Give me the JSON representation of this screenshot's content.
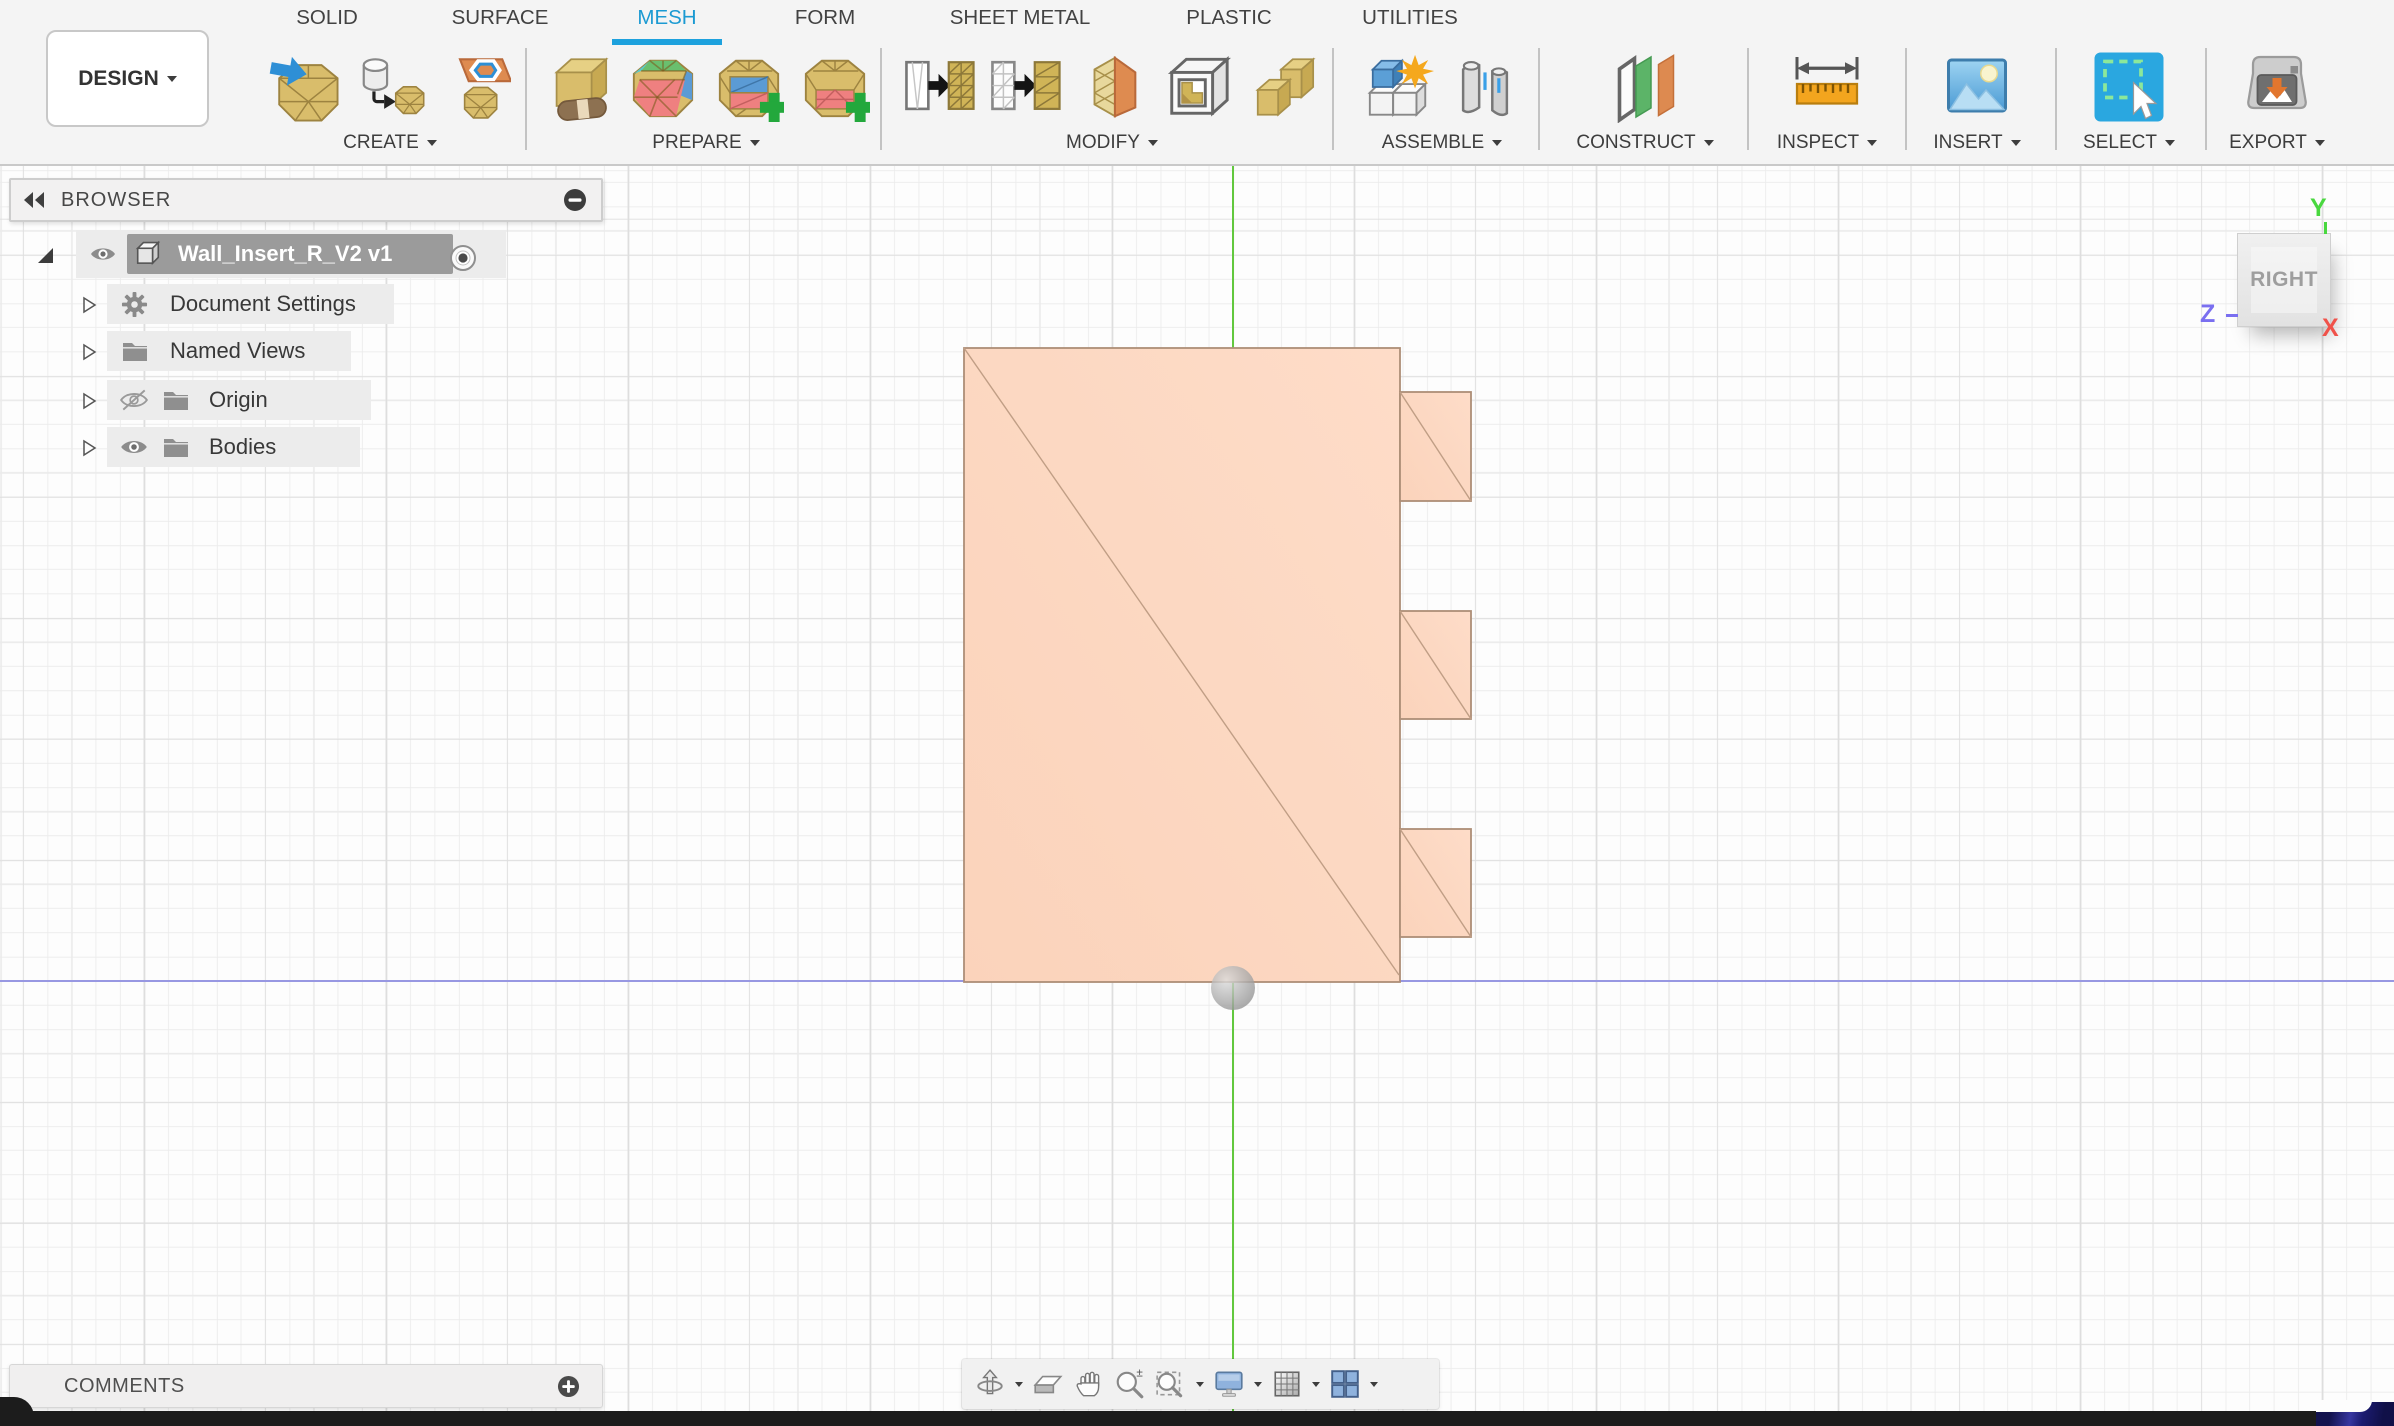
{
  "toolbar": {
    "document_menu_label": "DESIGN",
    "tabs": [
      {
        "label": "SOLID",
        "active": false
      },
      {
        "label": "SURFACE",
        "active": false
      },
      {
        "label": "MESH",
        "active": true
      },
      {
        "label": "FORM",
        "active": false
      },
      {
        "label": "SHEET METAL",
        "active": false
      },
      {
        "label": "PLASTIC",
        "active": false
      },
      {
        "label": "UTILITIES",
        "active": false
      }
    ],
    "groups": [
      {
        "label": "CREATE",
        "icons": [
          "insert-mesh",
          "create-mesh",
          "tessellate"
        ]
      },
      {
        "label": "PREPARE",
        "icons": [
          "repair",
          "generate-face-groups",
          "remesh",
          "reduce"
        ]
      },
      {
        "label": "MODIFY",
        "icons": [
          "plane-cut",
          "plane-cut-fill",
          "erase-and-fill",
          "shell",
          "merge-bodies"
        ]
      },
      {
        "label": "ASSEMBLE",
        "icons": [
          "new-component",
          "joint"
        ]
      },
      {
        "label": "CONSTRUCT",
        "icons": [
          "construct-plane"
        ]
      },
      {
        "label": "INSPECT",
        "icons": [
          "measure"
        ]
      },
      {
        "label": "INSERT",
        "icons": [
          "insert-image"
        ]
      },
      {
        "label": "SELECT",
        "icons": [
          "select-cursor"
        ]
      },
      {
        "label": "EXPORT",
        "icons": [
          "export-3d-print"
        ]
      }
    ],
    "accent_color": "#1da1dd"
  },
  "browser": {
    "title": "BROWSER",
    "root_item": {
      "label": "Wall_Insert_R_V2 v1",
      "visible": true,
      "selected": true
    },
    "items": [
      {
        "label": "Document Settings",
        "icon": "gear"
      },
      {
        "label": "Named Views",
        "icon": "folder"
      },
      {
        "label": "Origin",
        "icon": "folder",
        "visibility": "hidden"
      },
      {
        "label": "Bodies",
        "icon": "folder",
        "visibility": "visible"
      }
    ]
  },
  "viewcube": {
    "face_label": "RIGHT",
    "axis_x_label": "X",
    "axis_y_label": "Y",
    "axis_z_label": "Z",
    "axis_colors": {
      "x": "#f0524a",
      "y": "#49d83f",
      "z": "#7a6ff0"
    }
  },
  "comments": {
    "label": "COMMENTS"
  },
  "navbar": {
    "icons": [
      "orbit",
      "look-at",
      "pan",
      "zoom",
      "zoom-window",
      "display-settings",
      "grid-display",
      "viewports"
    ]
  },
  "canvas": {
    "mesh_body_color": "#fcd8c2",
    "grid_minor_color": "#ebebeb",
    "grid_major_color": "#dedede",
    "axis_vertical_color": "#62c83e",
    "axis_horizontal_color": "#9898e2"
  }
}
